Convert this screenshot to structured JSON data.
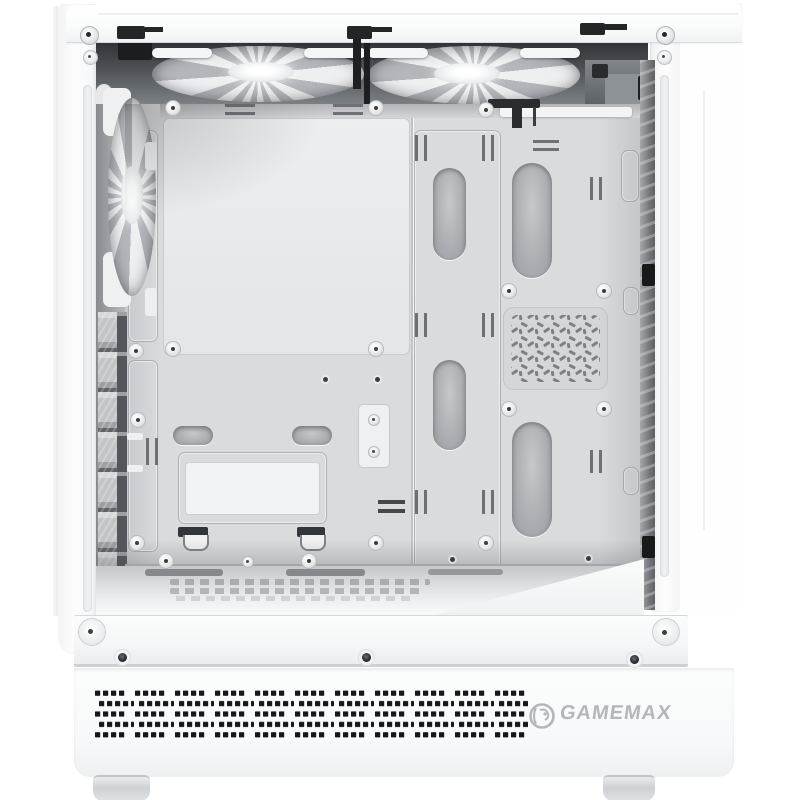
{
  "image": {
    "type": "product-photo",
    "subject": "White mid-tower gaming PC case, side panel removed, interior view",
    "background": "#ffffff"
  },
  "brand": {
    "name": "GAMEMAX",
    "logo_icon": "lion-head-icon"
  },
  "colors": {
    "case-white": "#fbfcfc",
    "tray-gray": "#d9dbdd",
    "interior-dark": "#33373a",
    "vent-dots": "#161718",
    "logo-gray": "#b4b6b9"
  },
  "parts": {
    "top": [
      "top-panel",
      "two-top-fans",
      "thumbscrews"
    ],
    "rear": [
      "rear-exhaust-fan",
      "seven-pci-slot-covers"
    ],
    "tray": [
      "motherboard-tray",
      "cable-grommets",
      "hex-vent",
      "ssd-bracket"
    ],
    "bottom": [
      "floor-vents",
      "bottom-rail",
      "dust-filter-dot-vent",
      "gamemax-logo",
      "case-feet"
    ]
  }
}
